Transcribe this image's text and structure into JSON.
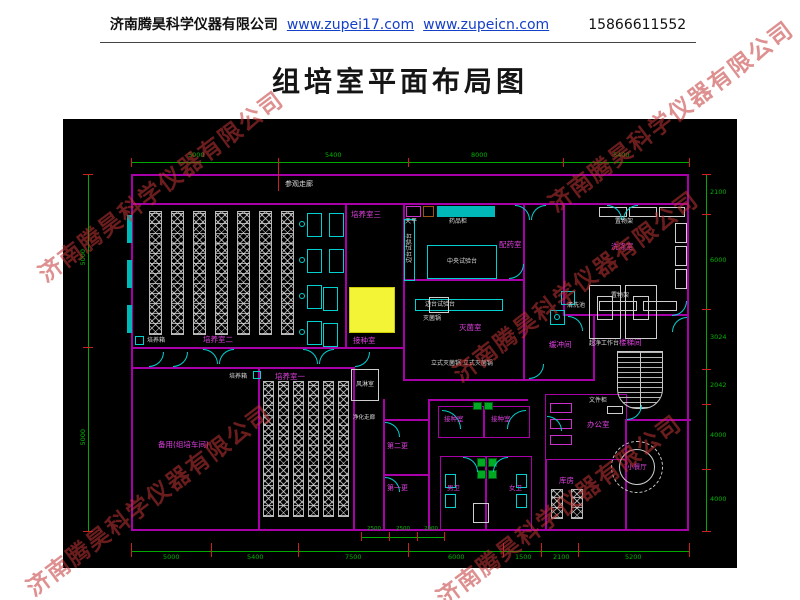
{
  "header": {
    "company": "济南腾昊科学仪器有限公司",
    "link1": "www.zupei17.com",
    "link2": "www.zupeicn.com",
    "phone": "15866611552"
  },
  "title": "组培室平面布局图",
  "watermark": "济南腾昊科学仪器有限公司",
  "plan": {
    "corridor": "参观走廊",
    "rooms": {
      "culture2": "培养室二",
      "culture3": "培养室三",
      "culture1": "培养室一",
      "inoculation": "接种室",
      "pharmacy": "配药室",
      "sterilize": "灭菌室",
      "buffer": "缓冲间",
      "washing": "洗涤室",
      "spare": "备用(组培车间)",
      "airshower": "风淋室",
      "clean_corridor": "净化走廊",
      "change2": "第二更",
      "change1": "第一更",
      "inoc1": "接种室",
      "inoc2": "接种室",
      "office": "办公室",
      "storage": "库房",
      "toilet_m": "男卫",
      "toilet_f": "女卫",
      "dining": "小餐厅",
      "stair": "楼梯间"
    },
    "equipment": {
      "central_bench": "中央试验台",
      "side_bench": "边台试验台",
      "balance": "天平",
      "medicine_cabinet": "药品柜",
      "autoclave": "灭菌锅",
      "sterilizer_row": "立式灭菌锅 立式灭菌锅",
      "incubator": "培养箱",
      "shelf": "置物架",
      "clean_bench": "超净工作台",
      "sink": "清洗池",
      "file_cabinet": "文件柜"
    },
    "dims": {
      "top": [
        "5000",
        "5400",
        "8000",
        "5400"
      ],
      "left": [
        "5000",
        "5000"
      ],
      "right": [
        "2100",
        "6000",
        "3024",
        "2042",
        "4000",
        "4000"
      ],
      "bottom": [
        "5000",
        "5400",
        "7500",
        "6000",
        "1500",
        "2100",
        "5200"
      ],
      "bottom_sub": [
        "2500",
        "2500",
        "2000"
      ]
    },
    "colors": {
      "wall": "#a800a8",
      "fixture": "#00d0d0",
      "dimension": "#00a800",
      "tick": "#cc2020",
      "room_label": "#e040e0",
      "equipment_label": "#dcdcdc",
      "highlight": "#f4f436",
      "canvas": "#000000"
    }
  }
}
